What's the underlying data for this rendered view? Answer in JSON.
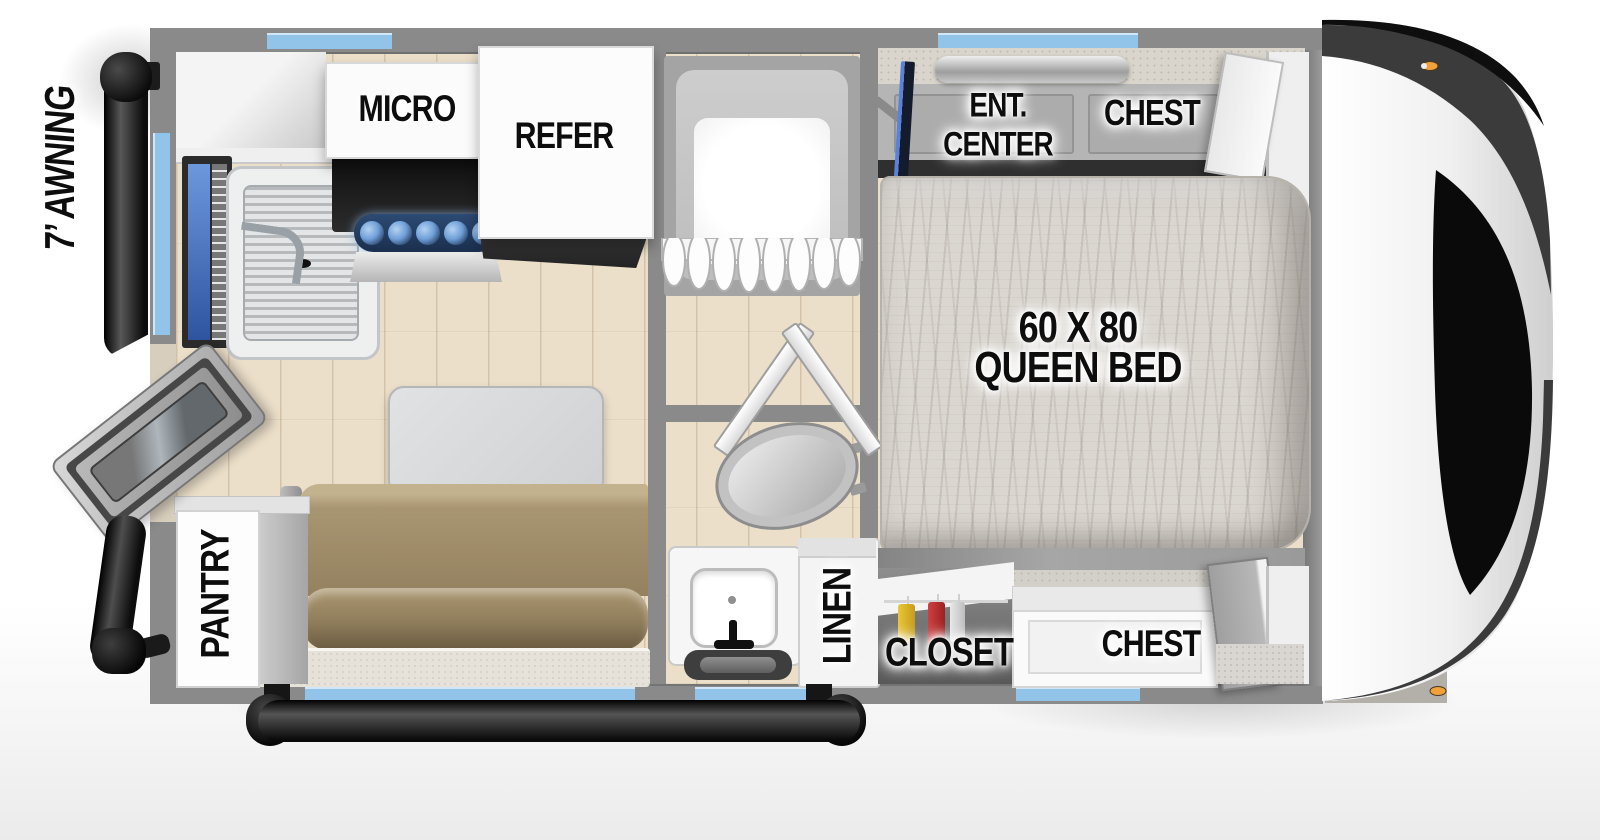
{
  "labels": {
    "awning": "7’ AWNING",
    "micro": "MICRO",
    "refer": "REFER",
    "ent_center_l1": "ENT.",
    "ent_center_l2": "CENTER",
    "chest_top": "CHEST",
    "bed_l1": "60 X 80",
    "bed_l2": "QUEEN BED",
    "pantry": "PANTRY",
    "linen": "LINEN",
    "closet": "CLOSET",
    "chest_bottom": "CHEST"
  },
  "colors": {
    "wall": "#8a8a8a",
    "window-blue": "#92c4ea",
    "floor-wood": "#ebdfc9",
    "sofa-tan": "#a89572",
    "sofa-back": "#8f7d5c",
    "burner-strip": "#2c4a74",
    "burner-blue": "#6f9fd8",
    "label-ink": "#0d0d0d",
    "cap-dark": "#3b3b3b",
    "marker-orange": "#f2a13a"
  }
}
